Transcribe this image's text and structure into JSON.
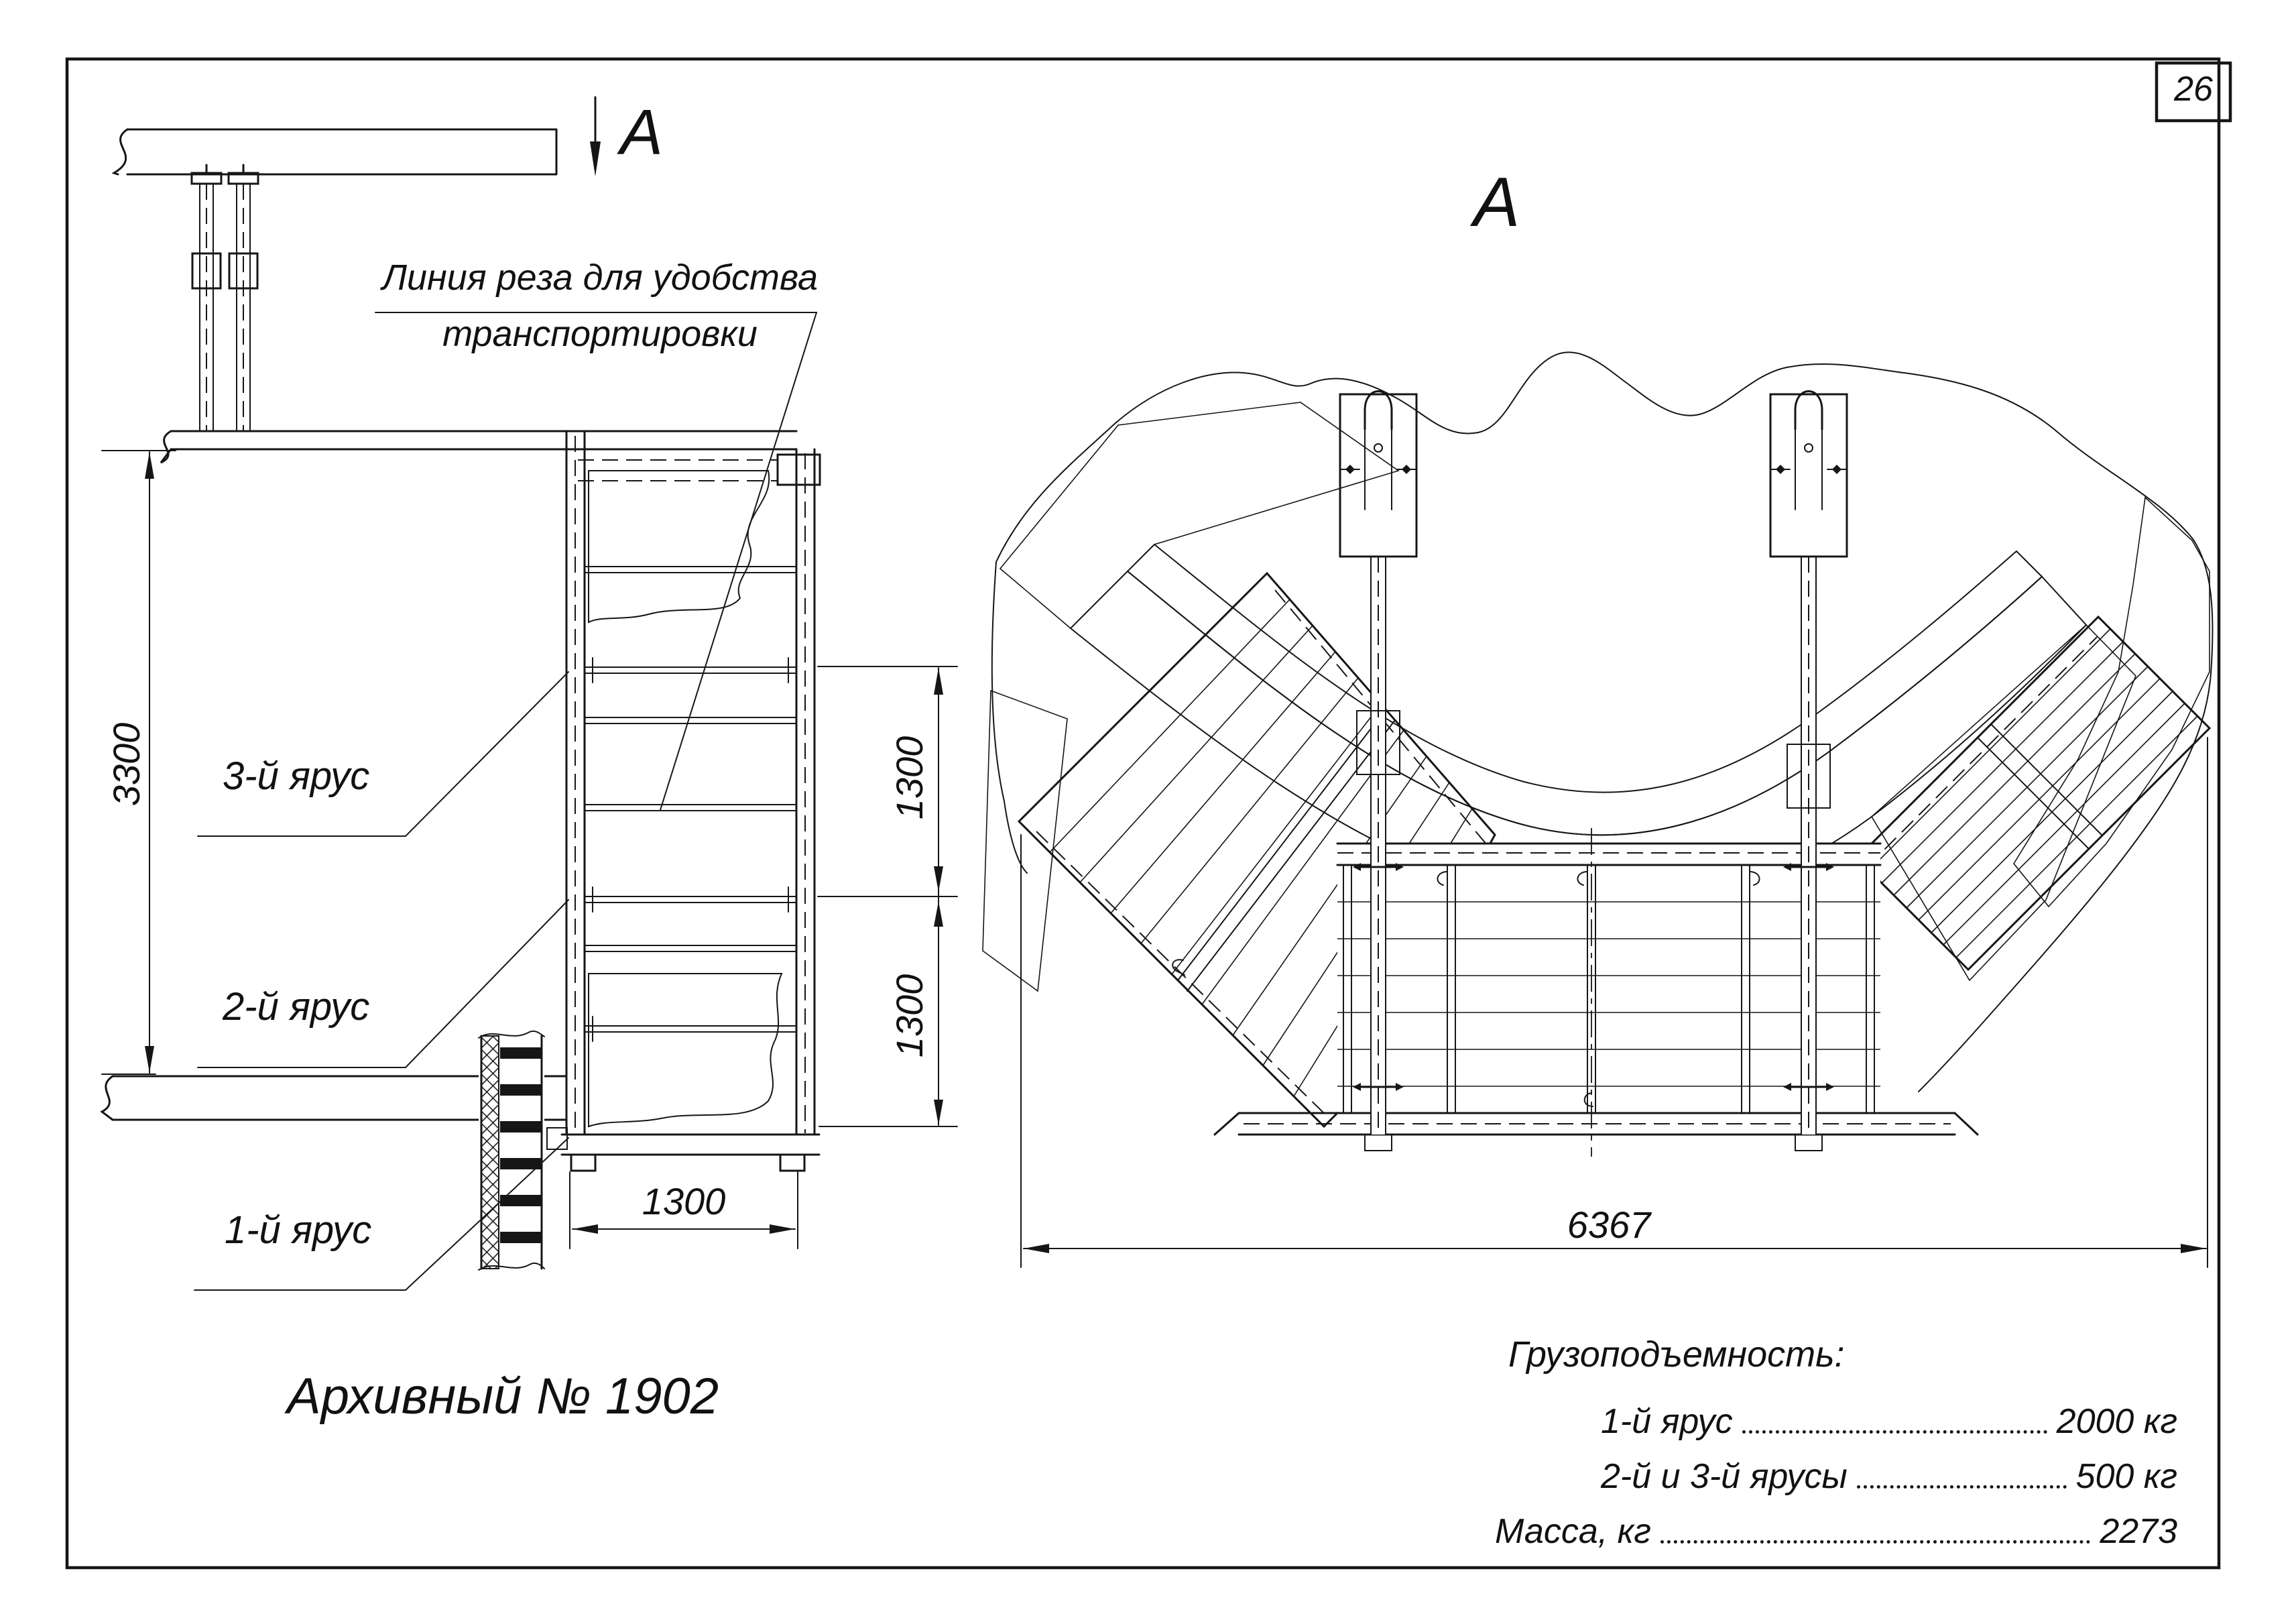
{
  "page": {
    "number": "26"
  },
  "colors": {
    "ink": "#161616",
    "paper": "#ffffff"
  },
  "drawing": {
    "archive_label": "Архивный № 1902",
    "section_marker": "A",
    "view_label": "A",
    "cut_note": {
      "line1": "Линия реза для удобства",
      "line2": "транспортировки"
    },
    "tiers": {
      "tier3": "3-й ярус",
      "tier2": "2-й ярус",
      "tier1": "1-й ярус"
    },
    "dimensions": {
      "total_height": "3300",
      "tier_gap_upper": "1300",
      "tier_gap_lower": "1300",
      "tower_width": "1300",
      "plan_width": "6367"
    },
    "specs": {
      "title": "Грузоподъемность:",
      "rows": [
        {
          "label": "1-й ярус",
          "value": "2000 кг"
        },
        {
          "label": "2-й и 3-й ярусы",
          "value": "500 кг"
        },
        {
          "label": "Масса, кг",
          "value": "2273"
        }
      ]
    }
  }
}
